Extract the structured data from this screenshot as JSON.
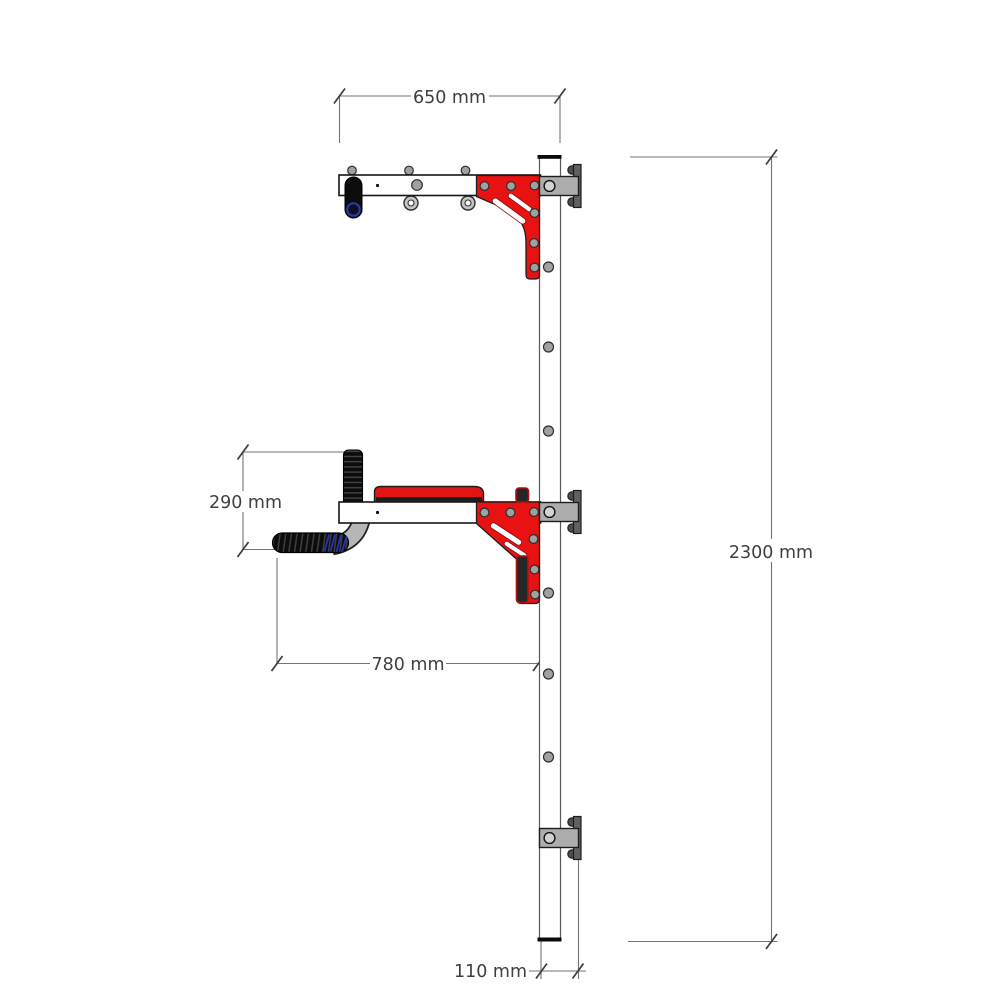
{
  "drawing": {
    "type": "technical-side-view",
    "subject": "wall-mounted pull-up and dip bar frame",
    "unit": "mm"
  },
  "dimensions": [
    {
      "id": "top-arm-width",
      "label": "650 mm"
    },
    {
      "id": "overall-height",
      "label": "2300 mm"
    },
    {
      "id": "handle-drop",
      "label": "290 mm"
    },
    {
      "id": "dip-arm-reach",
      "label": "780 mm"
    },
    {
      "id": "post-depth",
      "label": "110 mm"
    }
  ],
  "components": {
    "vertical_post": "wall post with bolt holes",
    "wall_brackets": 3,
    "top_arm": "pull-up arm with grip, eyelets and red gusset bracket",
    "mid_arm": "dip arm with cushion pad, knurled grips and red gusset bracket",
    "lower_handle": "curved knurled handle"
  },
  "colors": {
    "bracket_red": "#e81212",
    "cushion_red": "#e41414",
    "steel_gray": "#adadad",
    "plate_gray": "#606060",
    "grip_black": "#0c0c0c",
    "grip_blue_accent": "#2636c8",
    "dimension_line": "#737373",
    "dimension_text": "#3f3f3f",
    "background": "#ffffff"
  }
}
